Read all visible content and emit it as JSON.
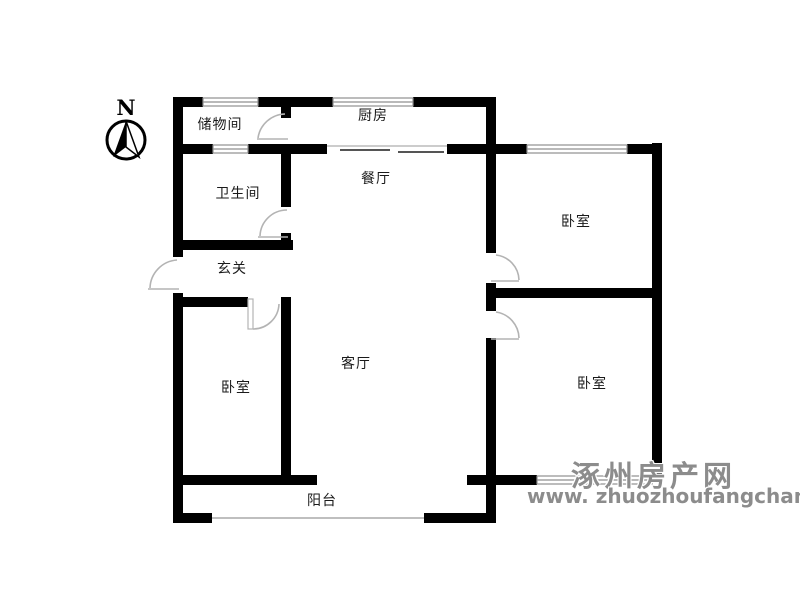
{
  "compass": {
    "label": "N"
  },
  "rooms": [
    {
      "id": "storage",
      "label": "储物间"
    },
    {
      "id": "kitchen",
      "label": "厨房"
    },
    {
      "id": "bathroom",
      "label": "卫生间"
    },
    {
      "id": "dining",
      "label": "餐厅"
    },
    {
      "id": "bedroom-ne",
      "label": "卧室"
    },
    {
      "id": "entry",
      "label": "玄关"
    },
    {
      "id": "bedroom-w",
      "label": "卧室"
    },
    {
      "id": "living",
      "label": "客厅"
    },
    {
      "id": "bedroom-se",
      "label": "卧室"
    },
    {
      "id": "balcony",
      "label": "阳台"
    }
  ],
  "watermark": {
    "line1": "涿州房产网",
    "line2": "www. zhuozhoufangchan. com"
  },
  "colors": {
    "wall": "#000000",
    "window_stroke": "#8f8f8f",
    "window_fill": "#f2f2f2",
    "door_arc": "#b3b3b3",
    "label_text": "#1a1a1a",
    "watermark": "#8c8c8c"
  }
}
